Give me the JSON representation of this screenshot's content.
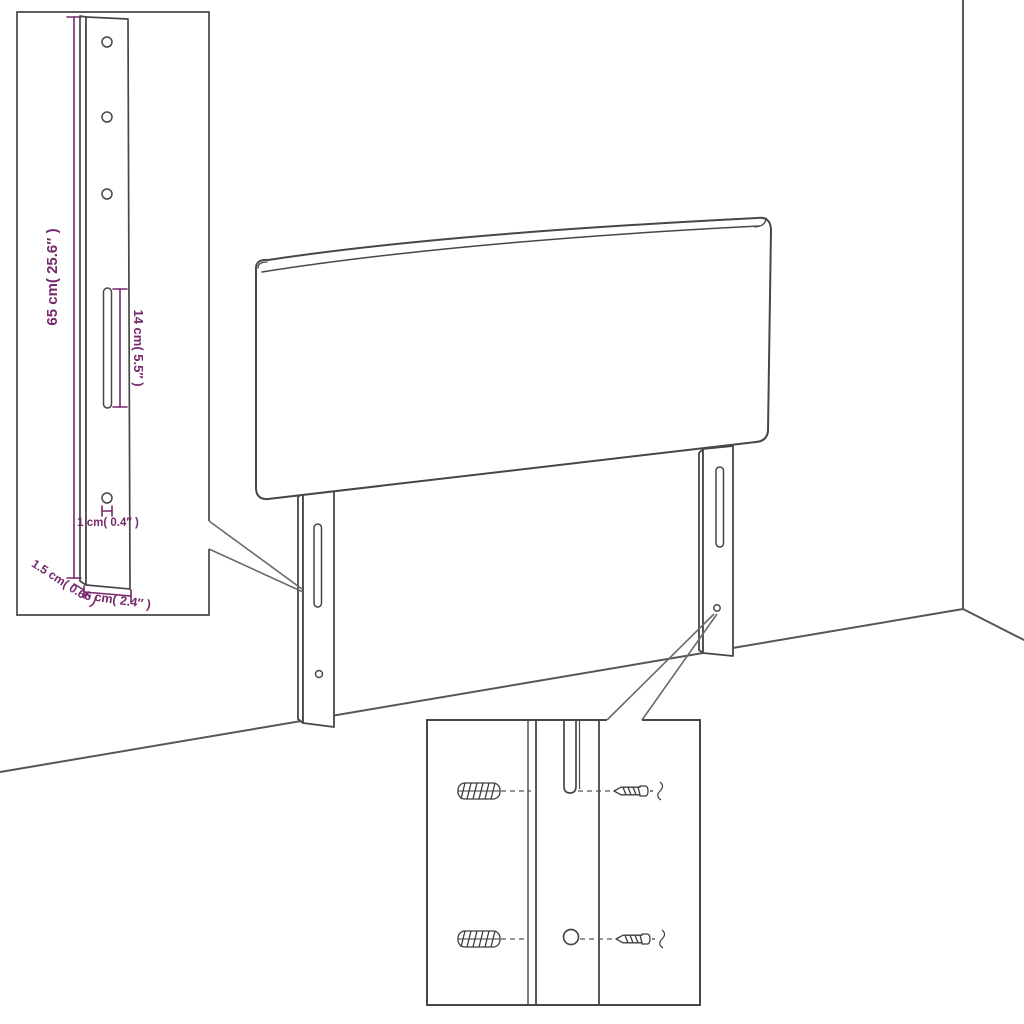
{
  "illustration": {
    "type": "furniture-assembly-diagram",
    "subject": "upholstered headboard with two mounting legs, bracket dimension inset and wall-fixing hardware inset"
  },
  "colors": {
    "line": "#474747",
    "room_line": "#565656",
    "dimension": "#76296b",
    "background": "#ffffff"
  },
  "bracket_inset": {
    "labels": {
      "bracket_height": "65 cm( 25.6″ )",
      "slot_length": "14 cm( 5.5″ )",
      "hole_diameter": "1 cm( 0.4″ )",
      "bracket_thickness": "1.5 cm( 0.6″ )",
      "bracket_width": "6 cm( 2.4″ )"
    }
  },
  "hardware_inset": {
    "icons": [
      "wall-plug-icon",
      "screw-icon"
    ]
  }
}
